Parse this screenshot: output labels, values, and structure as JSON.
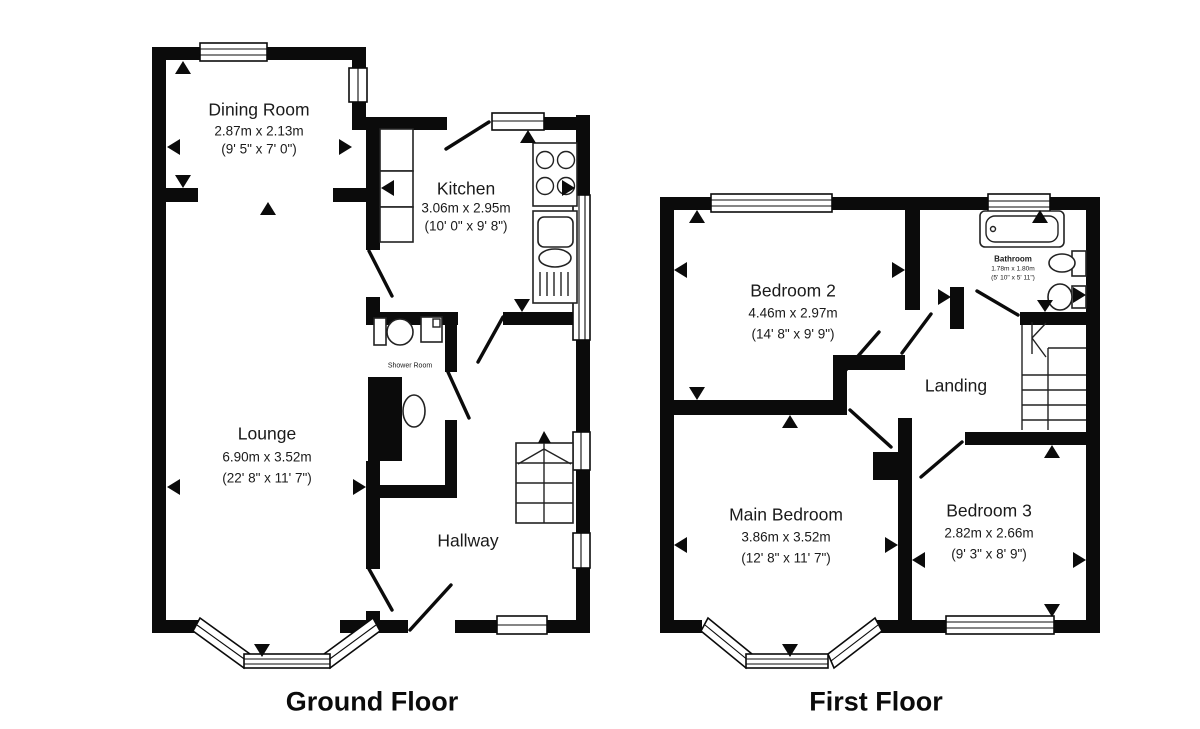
{
  "document": {
    "type": "floorplan",
    "background": "#ffffff",
    "wall_color": "#0b0b0b"
  },
  "floors": [
    {
      "id": "ground",
      "title": "Ground Floor",
      "rooms": [
        {
          "name": "Dining Room",
          "dim_metric": "2.87m x 2.13m",
          "dim_imperial": "(9' 5\" x 7' 0\")"
        },
        {
          "name": "Kitchen",
          "dim_metric": "3.06m x 2.95m",
          "dim_imperial": "(10' 0\" x 9' 8\")"
        },
        {
          "name": "Lounge",
          "dim_metric": "6.90m x 3.52m",
          "dim_imperial": "(22' 8\" x 11' 7\")"
        },
        {
          "name": "Shower Room"
        },
        {
          "name": "Hallway"
        }
      ]
    },
    {
      "id": "first",
      "title": "First Floor",
      "rooms": [
        {
          "name": "Bedroom 2",
          "dim_metric": "4.46m x 2.97m",
          "dim_imperial": "(14' 8\" x 9' 9\")"
        },
        {
          "name": "Bathroom",
          "dim_metric": "1.78m x 1.80m",
          "dim_imperial": "(5' 10\" x 5' 11\")"
        },
        {
          "name": "Landing"
        },
        {
          "name": "Main Bedroom",
          "dim_metric": "3.86m x 3.52m",
          "dim_imperial": "(12' 8\" x 11' 7\")"
        },
        {
          "name": "Bedroom 3",
          "dim_metric": "2.82m x 2.66m",
          "dim_imperial": "(9' 3\" x 8' 9\")"
        }
      ]
    }
  ]
}
